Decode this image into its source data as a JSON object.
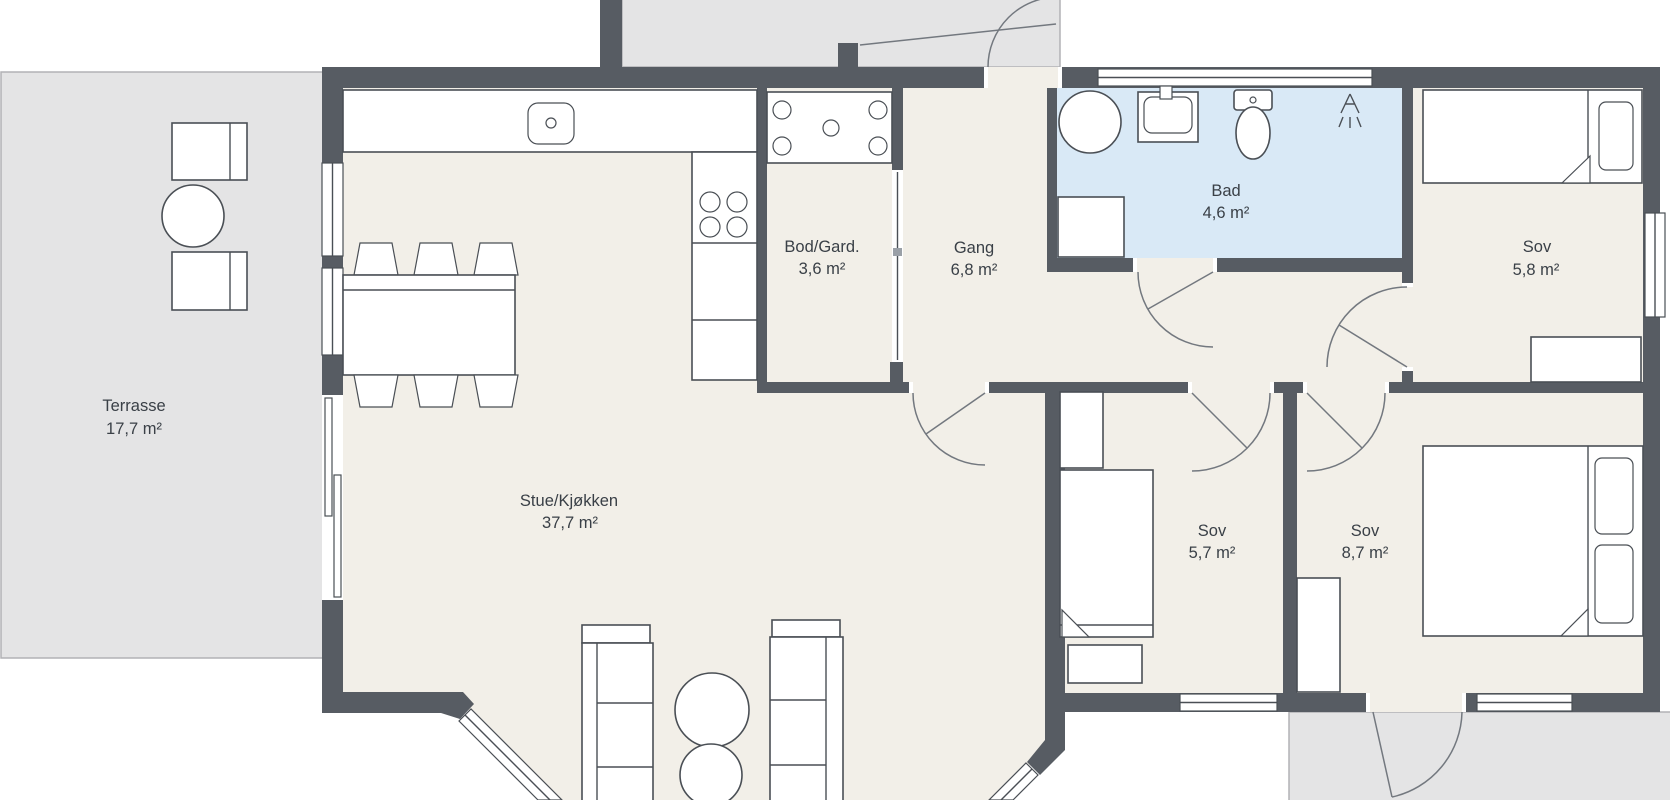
{
  "title": "Floor plan",
  "colors": {
    "wall": "#575c63",
    "floor": "#f2efe8",
    "bath": "#d9e9f6",
    "outdoor": "#e4e4e5",
    "outdoor_border": "#b2b2b5",
    "line": "#4a4f55",
    "swing": "#73787f",
    "text": "#3a4047"
  },
  "rooms": [
    {
      "id": "terrasse",
      "name": "Terrasse",
      "area": "17,7 m²"
    },
    {
      "id": "stue-kjokken",
      "name": "Stue/Kjøkken",
      "area": "37,7 m²"
    },
    {
      "id": "bod-gard",
      "name": "Bod/Gard.",
      "area": "3,6 m²"
    },
    {
      "id": "gang",
      "name": "Gang",
      "area": "6,8 m²"
    },
    {
      "id": "bad",
      "name": "Bad",
      "area": "4,6 m²"
    },
    {
      "id": "sov-topright",
      "name": "Sov",
      "area": "5,8 m²"
    },
    {
      "id": "sov-middle",
      "name": "Sov",
      "area": "5,7 m²"
    },
    {
      "id": "sov-right",
      "name": "Sov",
      "area": "8,7 m²"
    }
  ]
}
